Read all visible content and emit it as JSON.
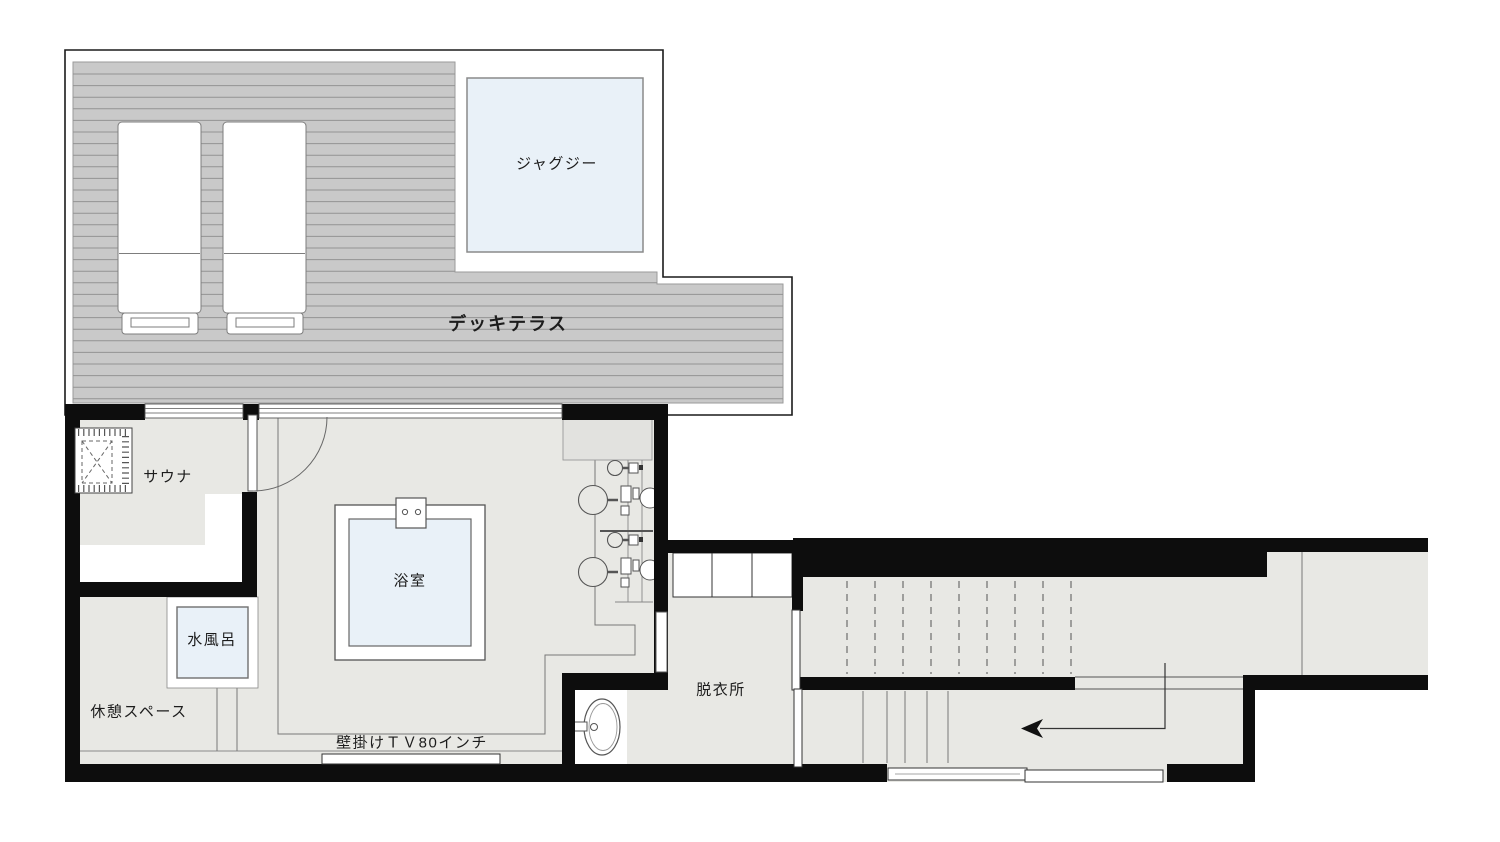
{
  "labels": {
    "jacuzzi": "ジャグジー",
    "deck_terrace": "デッキテラス",
    "sauna": "サウナ",
    "bath": "浴室",
    "cold_bath": "水風呂",
    "rest_space": "休憩スペース",
    "wall_tv": "壁掛けＴＶ80インチ",
    "dressing_room": "脱衣所"
  },
  "colors": {
    "background": "#ffffff",
    "wall": "#0d0d0d",
    "deck": "#c9c9c9",
    "deck_plank": "#939393",
    "floor": "#e8e8e4",
    "water": "#e9f1f8",
    "line": "#777777"
  },
  "icons": {
    "sauna-heater-icon": "hatched square with dashed X (sauna stove)",
    "lounger-icon": "deck lounge chair seen from above",
    "jacuzzi-icon": "square water tub",
    "bathtub-icon": "square tub with faucet",
    "shower-station-icon": "stool, basin and wall fittings",
    "washbasin-icon": "oval sink with tap",
    "stairs-up-icon": "dashed treads above cut plane",
    "stairs-icon": "solid treads",
    "direction-arrow-icon": "left-pointing circulation arrow",
    "sliding-door-icon": "double sliding panels",
    "hinged-door-icon": "leaf with quarter-circle swing"
  }
}
